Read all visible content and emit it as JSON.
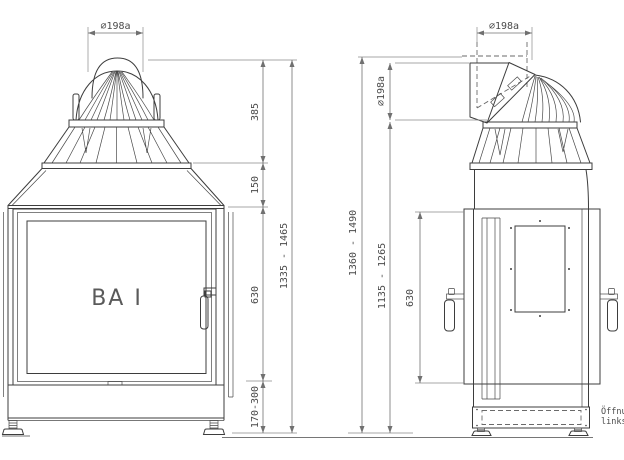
{
  "front_view": {
    "brand_label": "BA I",
    "flue_diameter": "⌀198a",
    "dims": {
      "dome": "385",
      "hood": "150",
      "door": "630",
      "base": "170-300",
      "total": "1335 - 1465"
    }
  },
  "side_view": {
    "flue_diameter_top": "⌀198a",
    "flue_diameter_rear": "⌀198a",
    "dims": {
      "total": "1360 - 1490",
      "outlet_to_floor": "1135 - 1265",
      "door": "630"
    }
  },
  "note": {
    "line1": "Öffnu",
    "line2": "links o"
  },
  "colors": {
    "background": "#ffffff",
    "line": "#3d3d3d",
    "dimension": "#707070",
    "text": "#4a4a4a"
  }
}
